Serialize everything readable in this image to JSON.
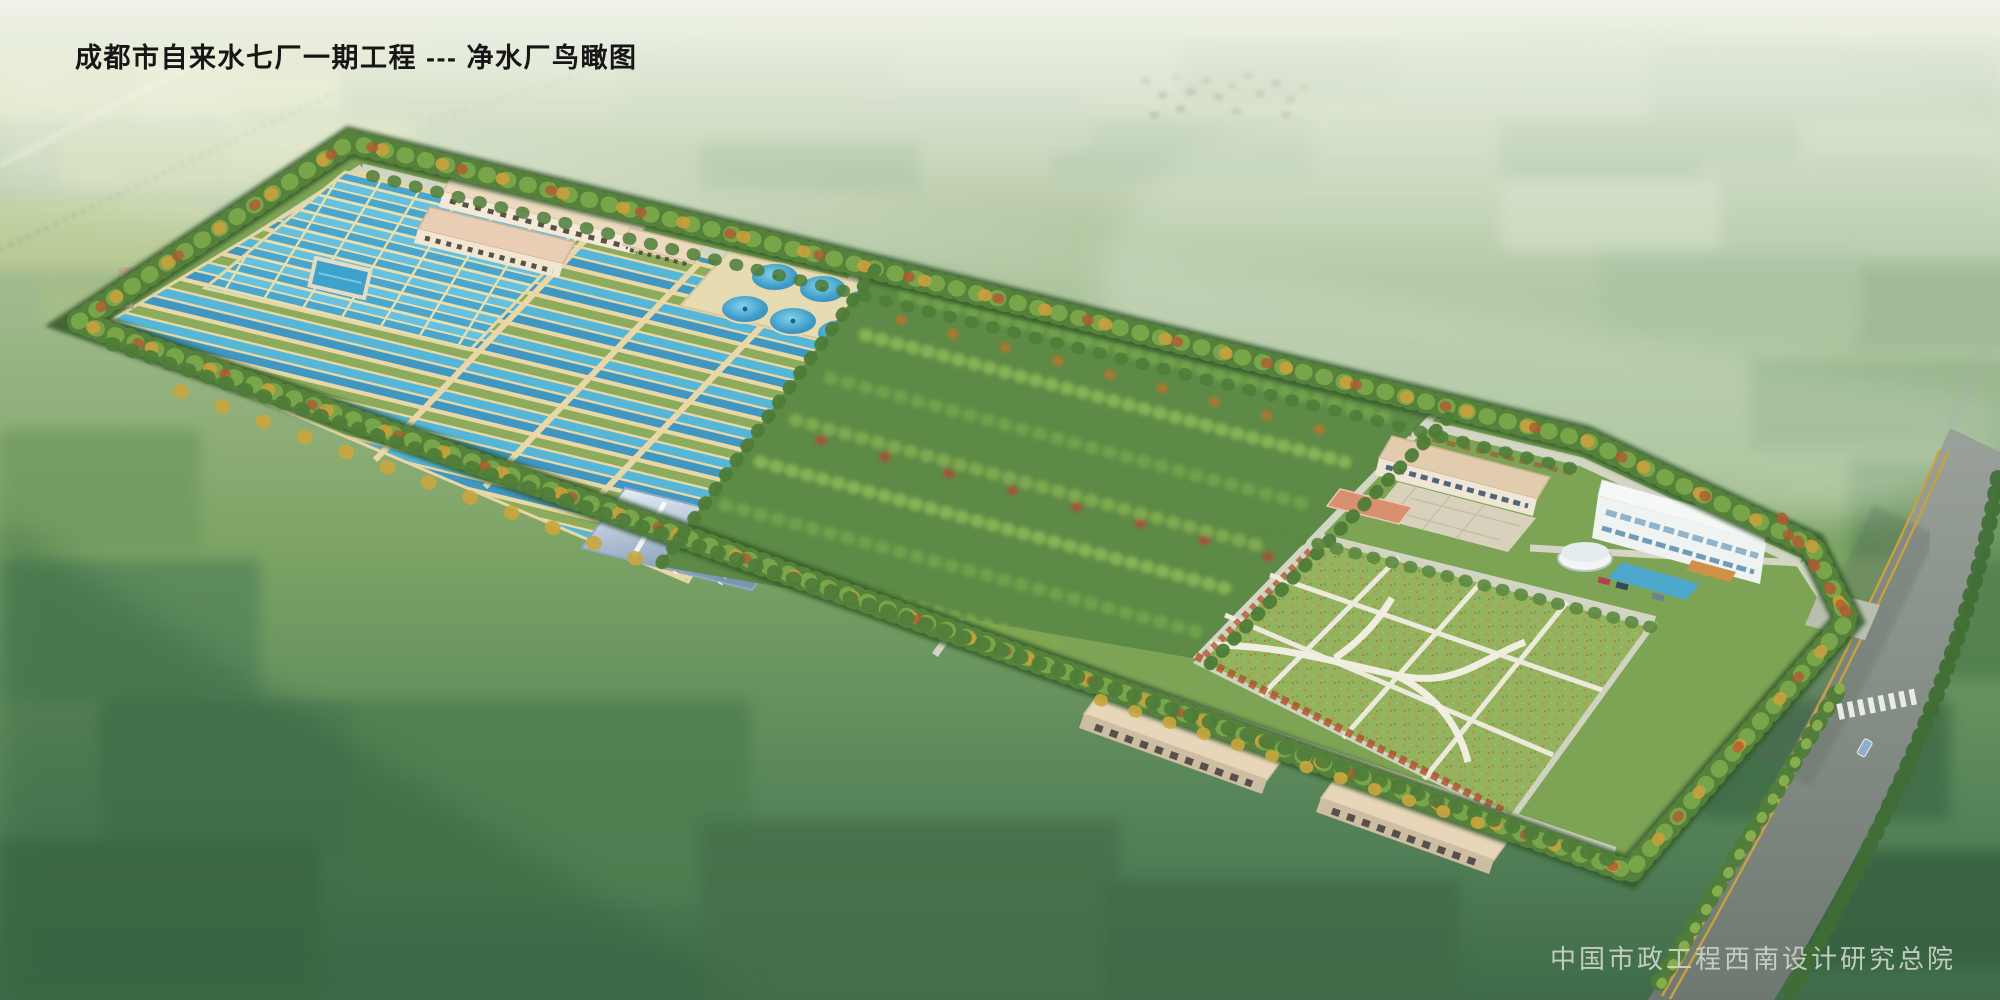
{
  "scene": {
    "title": "成都市自来水七厂一期工程 --- 净水厂鸟瞰图",
    "credit": "中国市政工程西南设计研究总院"
  },
  "palette": {
    "haze_field_green": "#a9c199",
    "dark_field_green": "#3e6b44",
    "pool_water_blue": "#4fb0d4",
    "basin_wall_beige": "#e9d8a6",
    "clarifier_blue": "#3f9cc8",
    "metal_roof_blue": "#8da6c2",
    "building_wall_cream": "#f0e6d2",
    "building_roof_pink": "#e8cdb2",
    "lawn_green": "#93b35e",
    "path_white": "#eceadb",
    "road_asphalt_gray": "#8a938d",
    "road_median_yellow": "#c8a23e",
    "tree_canopy_green": "#55813a",
    "tree_autumn_gold": "#c9a03c",
    "tree_autumn_red": "#b05a30"
  }
}
